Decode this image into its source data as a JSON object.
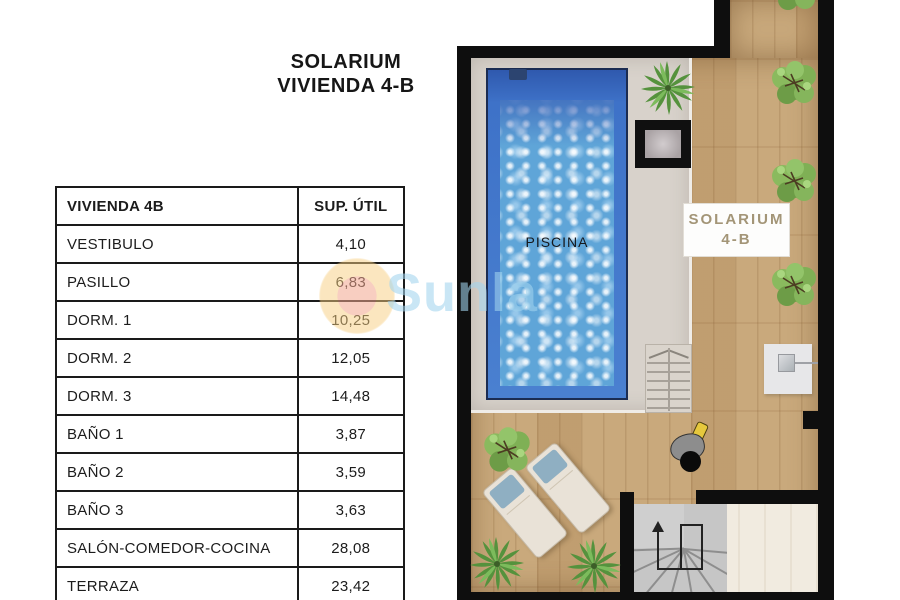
{
  "title": {
    "line1": "SOLARIUM",
    "line2": "VIVIENDA 4-B"
  },
  "table": {
    "headers": [
      "VIVIENDA 4B",
      "SUP. ÚTIL"
    ],
    "rows": [
      {
        "name": "VESTIBULO",
        "value": "4,10"
      },
      {
        "name": "PASILLO",
        "value": "6,83"
      },
      {
        "name": "DORM. 1",
        "value": "10,25"
      },
      {
        "name": "DORM. 2",
        "value": "12,05"
      },
      {
        "name": "DORM. 3",
        "value": "14,48"
      },
      {
        "name": "BAÑO 1",
        "value": "3,87"
      },
      {
        "name": "BAÑO 2",
        "value": "3,59"
      },
      {
        "name": "BAÑO 3",
        "value": "3,63"
      },
      {
        "name": "SALÓN-COMEDOR-COCINA",
        "value": "28,08"
      },
      {
        "name": "TERRAZA",
        "value": "23,42"
      }
    ]
  },
  "plan": {
    "pool_label": "PISCINA",
    "solarium_label": {
      "line1": "SOLARIUM",
      "line2": "4-B"
    }
  },
  "watermark": {
    "text": "Sunla"
  },
  "colors": {
    "wall_black": "#0e0e0e",
    "pool_wall_blue": "#3e72c8",
    "pool_water_blue": "#5fa5d8",
    "deck_wood_tan": "#c9a97c",
    "pool_surround_gray": "#d8d2cb",
    "interior_floor_cream": "#f1ebe0",
    "label_gold": "#a39577",
    "watermark_blue": "#a8d6ec",
    "watermark_sun_orange": "#f2a68e"
  }
}
